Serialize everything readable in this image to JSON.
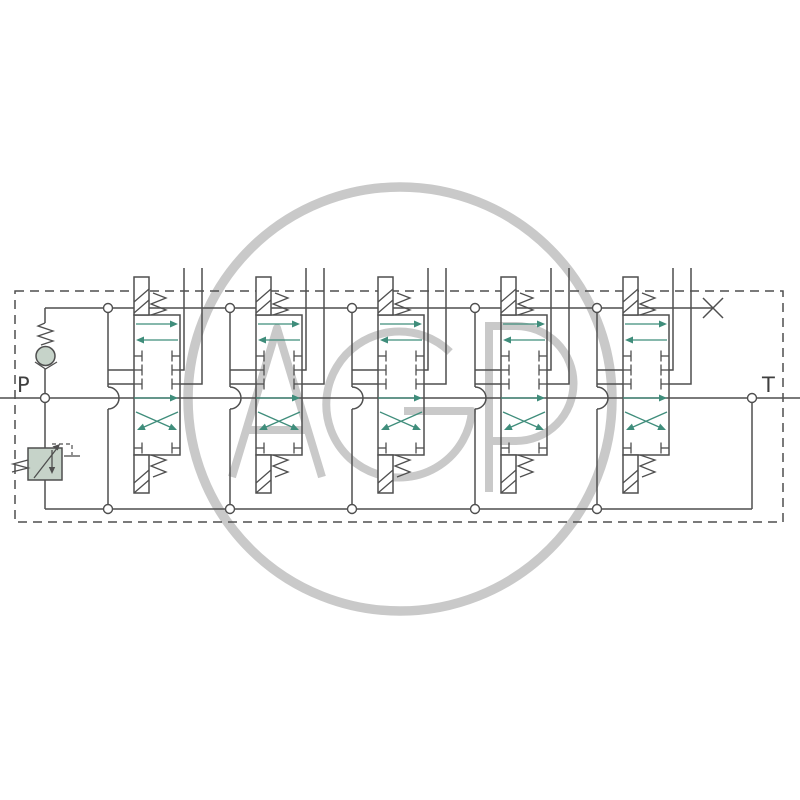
{
  "diagram": {
    "type": "hydraulic-schematic",
    "description": "5-section monoblock directional control valve block with inlet check valve, pilot-operated pressure relief valve, closed-center spool sections and plugged power-beyond port",
    "labels": {
      "pressure_port": "P",
      "tank_port": "T"
    },
    "watermark": {
      "text": "AGP"
    },
    "sections": {
      "count": 5,
      "x_positions": [
        108,
        230,
        352,
        475,
        597
      ],
      "positions_per_spool": 3,
      "spool_symbols": [
        "parallel-arrows",
        "closed-center-blocked",
        "crossed-arrows"
      ]
    },
    "plug": {
      "symbol": "X",
      "meaning": "plugged carryover port"
    },
    "colors": {
      "line": "#4f4f4f",
      "flow_arrow": "#3f8d7b",
      "component_fill": "#c6d3c9",
      "watermark": "#c9c9c9",
      "background": "#ffffff"
    },
    "geometry": {
      "bypass_line_y": 308,
      "pressure_line_y": 398,
      "return_line_y": 509,
      "envelope": {
        "x": 15,
        "y": 291,
        "w": 768,
        "h": 231
      }
    }
  }
}
